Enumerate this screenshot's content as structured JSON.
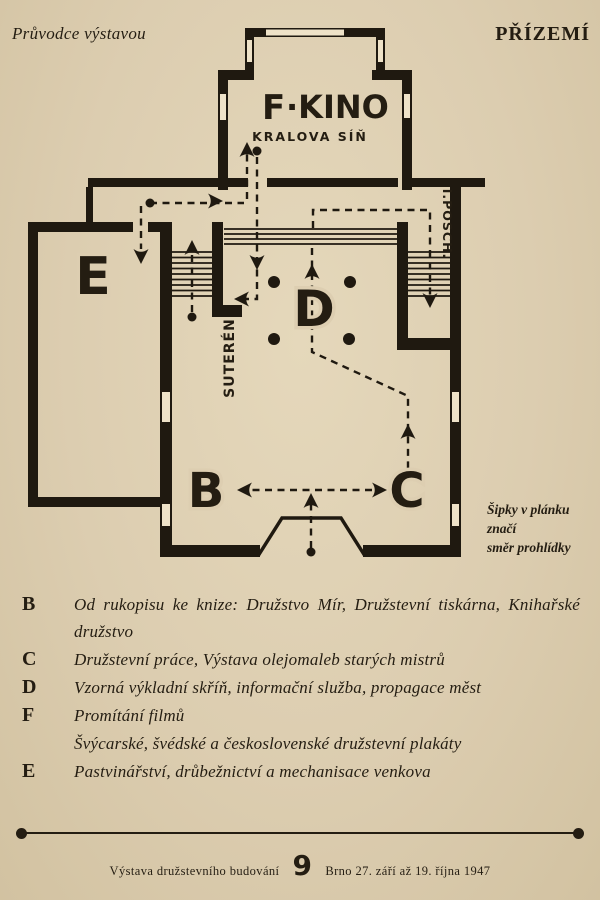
{
  "header": {
    "left": "Průvodce výstavou",
    "right": "PŘÍZEMÍ"
  },
  "plan": {
    "cinema_letter": "F",
    "cinema_name": "·KINO",
    "cinema_sub": "KRALOVA SÍŇ",
    "letter_b": "B",
    "letter_c": "C",
    "letter_d": "D",
    "letter_e": "E",
    "stairs_basement": "SUTERÉN",
    "stairs_first_floor": "I.POSCH."
  },
  "note": {
    "line1": "Šipky v plánku",
    "line2": "značí",
    "line3": "směr prohlídky"
  },
  "legend": [
    {
      "key": "B",
      "text": "Od rukopisu ke knize: Družstvo Mír, Družstevní tiskárna, Knihařské družstvo"
    },
    {
      "key": "C",
      "text": "Družstevní práce, Výstava olejomaleb starých mistrů"
    },
    {
      "key": "D",
      "text": "Vzorná výkladní skříň, informační služba, propagace měst"
    },
    {
      "key": "F",
      "text": "Promítání filmů",
      "text2": "Švýcarské, švédské a československé družstevní plakáty"
    },
    {
      "key": "E",
      "text": "Pastvinářství, drůbežnictví a mechanisace venkova"
    }
  ],
  "footer": {
    "left": "Výstava družstevního budování",
    "page_number": "9",
    "right": "Brno 27. září až 19. října 1947"
  },
  "colors": {
    "paper": "#dccdb0",
    "ink": "#241d12"
  }
}
